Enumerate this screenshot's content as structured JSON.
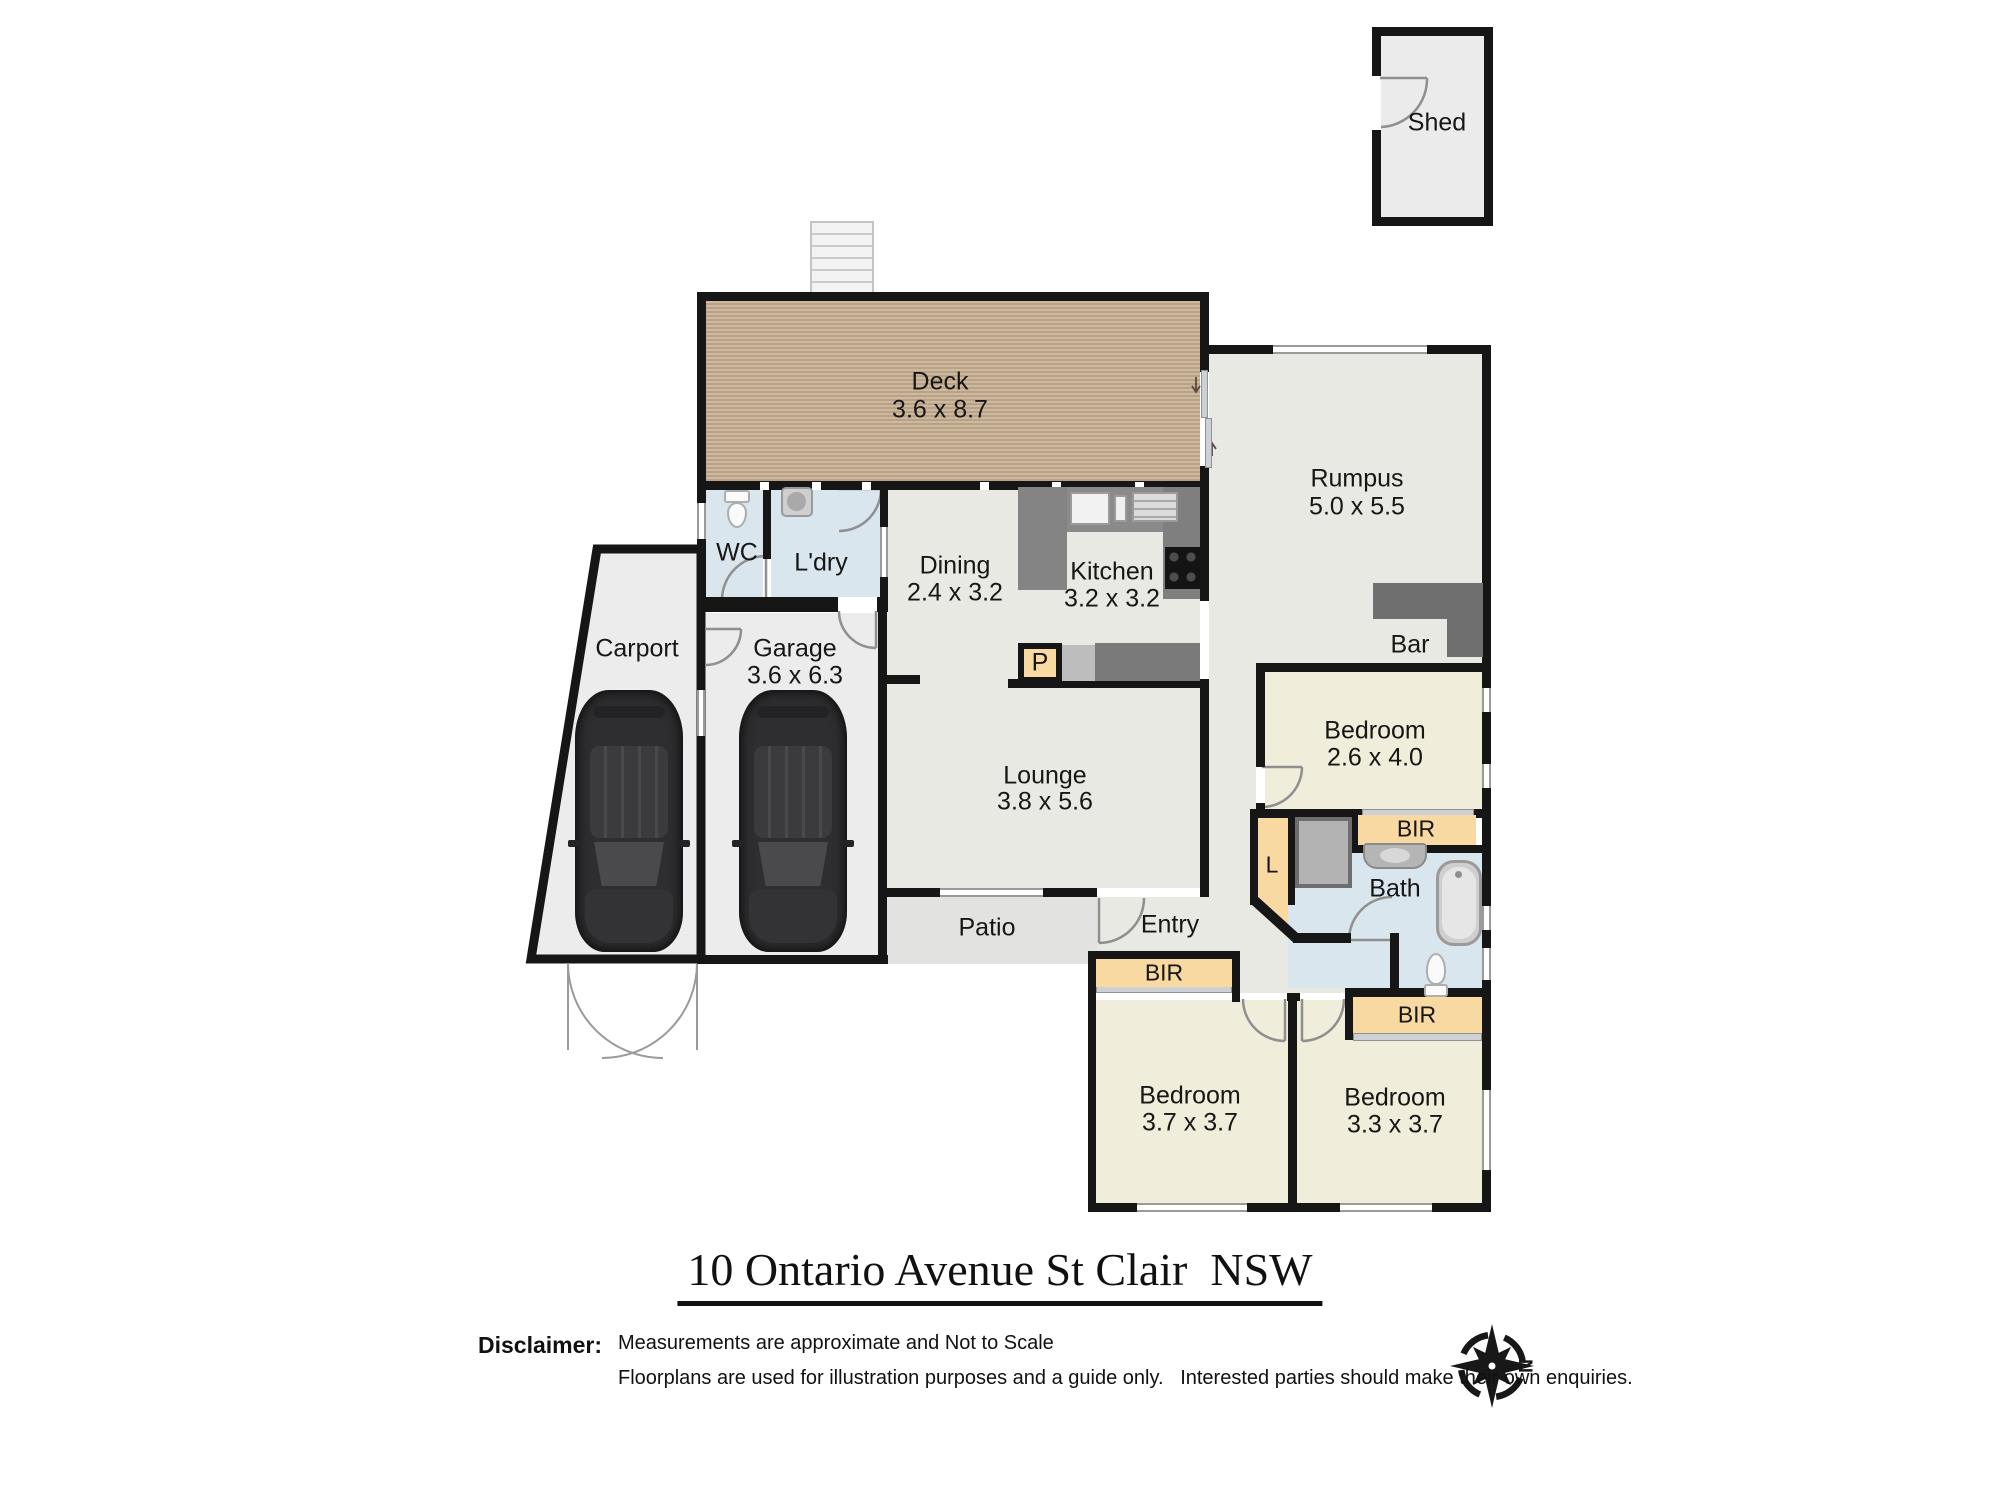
{
  "title": "10 Ontario Avenue St Clair  NSW",
  "disclaimer": {
    "label": "Disclaimer:",
    "line1": "Measurements are approximate and Not to Scale",
    "line2": "Floorplans are used for illustration purposes and a guide only.   Interested parties should make their own enquiries."
  },
  "compass": {
    "north": "N"
  },
  "rooms": {
    "shed": {
      "name": "Shed"
    },
    "deck": {
      "name": "Deck",
      "dims": "3.6 x 8.7"
    },
    "rumpus": {
      "name": "Rumpus",
      "dims": "5.0 x 5.5"
    },
    "bar": {
      "name": "Bar"
    },
    "wc": {
      "name": "WC"
    },
    "laundry": {
      "name": "L'dry"
    },
    "dining": {
      "name": "Dining",
      "dims": "2.4 x 3.2"
    },
    "kitchen": {
      "name": "Kitchen",
      "dims": "3.2 x 3.2"
    },
    "pantry": {
      "name": "P"
    },
    "carport": {
      "name": "Carport"
    },
    "garage": {
      "name": "Garage",
      "dims": "3.6 x 6.3"
    },
    "lounge": {
      "name": "Lounge",
      "dims": "3.8 x 5.6"
    },
    "patio": {
      "name": "Patio"
    },
    "entry": {
      "name": "Entry"
    },
    "bedroom_rear": {
      "name": "Bedroom",
      "dims": "2.6 x 4.0"
    },
    "linen": {
      "name": "L"
    },
    "bath": {
      "name": "Bath"
    },
    "bir_rear": {
      "name": "BIR"
    },
    "bir_left": {
      "name": "BIR"
    },
    "bir_right": {
      "name": "BIR"
    },
    "bedroom_left": {
      "name": "Bedroom",
      "dims": "3.7 x 3.7"
    },
    "bedroom_right": {
      "name": "Bedroom",
      "dims": "3.3 x 3.7"
    }
  },
  "colors": {
    "wall": "#161616",
    "deck_wood": "#c6ae90",
    "main_floor": "#e9e9e3",
    "bedroom_floor": "#f0edda",
    "wet_area": "#d9e6ed",
    "robe_tan": "#f8d9a2",
    "counter_gray": "#828282",
    "patio_gray": "#e2e2e1"
  }
}
